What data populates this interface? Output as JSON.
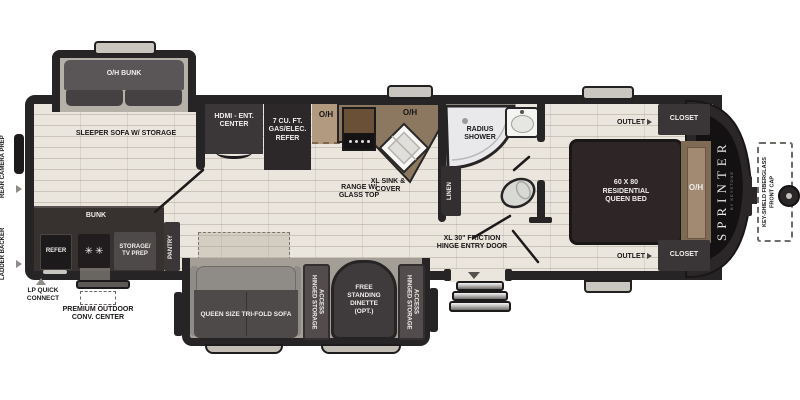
{
  "colors": {
    "wall": "#272425",
    "floor": "#ebe6dd",
    "counter": "#8c7861",
    "slide_floor": "#b6b1a8",
    "dark_furniture": "#4a4546",
    "bed": "#2d2526",
    "headboard": "#a18a71",
    "shower": "#e9e9eb"
  },
  "icons": {
    "burner": "✳"
  },
  "exterior": {
    "rear_camera_prep": "REAR CAMERA PREP",
    "ladder_backer": "LADDER BACKER",
    "lp_quick_connect": "LP QUICK CONNECT",
    "premium_outdoor_conv_center": "PREMIUM OUTDOOR CONV. CENTER",
    "front_cap_callout": "KEY-SHIELD FIBERGLASS FRONT CAP",
    "brand": "SPRINTER",
    "brand_sub": "BY KEYSTONE"
  },
  "bunk_room": {
    "oh_bunk": "O/H BUNK",
    "sleeper_sofa": "SLEEPER SOFA W/ STORAGE",
    "bunk": "BUNK",
    "refer": "REFER",
    "storage_tv_prep": "STORAGE/ TV PREP",
    "pantry": "PANTRY"
  },
  "kitchen": {
    "hdmi_ent_center": "HDMI - ENT. CENTER",
    "gas_elec_refer": "7 CU. FT. GAS/ELEC. REFER",
    "overhead_left": "O/H",
    "overhead_right": "O/H",
    "range": "RANGE W/ GLASS TOP",
    "sink": "XL SINK & COVER"
  },
  "bathroom": {
    "radius_shower": "RADIUS SHOWER",
    "linen": "LINEN"
  },
  "entry": {
    "door_label": "XL 30\" FRICTION HINGE ENTRY DOOR"
  },
  "bedroom": {
    "outlet_top": "OUTLET",
    "closet_top": "CLOSET",
    "outlet_bottom": "OUTLET",
    "closet_bottom": "CLOSET",
    "queen_bed": "60 X 80 RESIDENTIAL QUEEN BED",
    "overhead": "O/H"
  },
  "slideout": {
    "tri_fold_sofa": "QUEEN SIZE TRI-FOLD SOFA",
    "hinged_left": "HINGED STORAGE ACCESS",
    "dinette": "FREE STANDING DINETTE (OPT.)",
    "hinged_right": "HINGED STORAGE ACCESS"
  }
}
